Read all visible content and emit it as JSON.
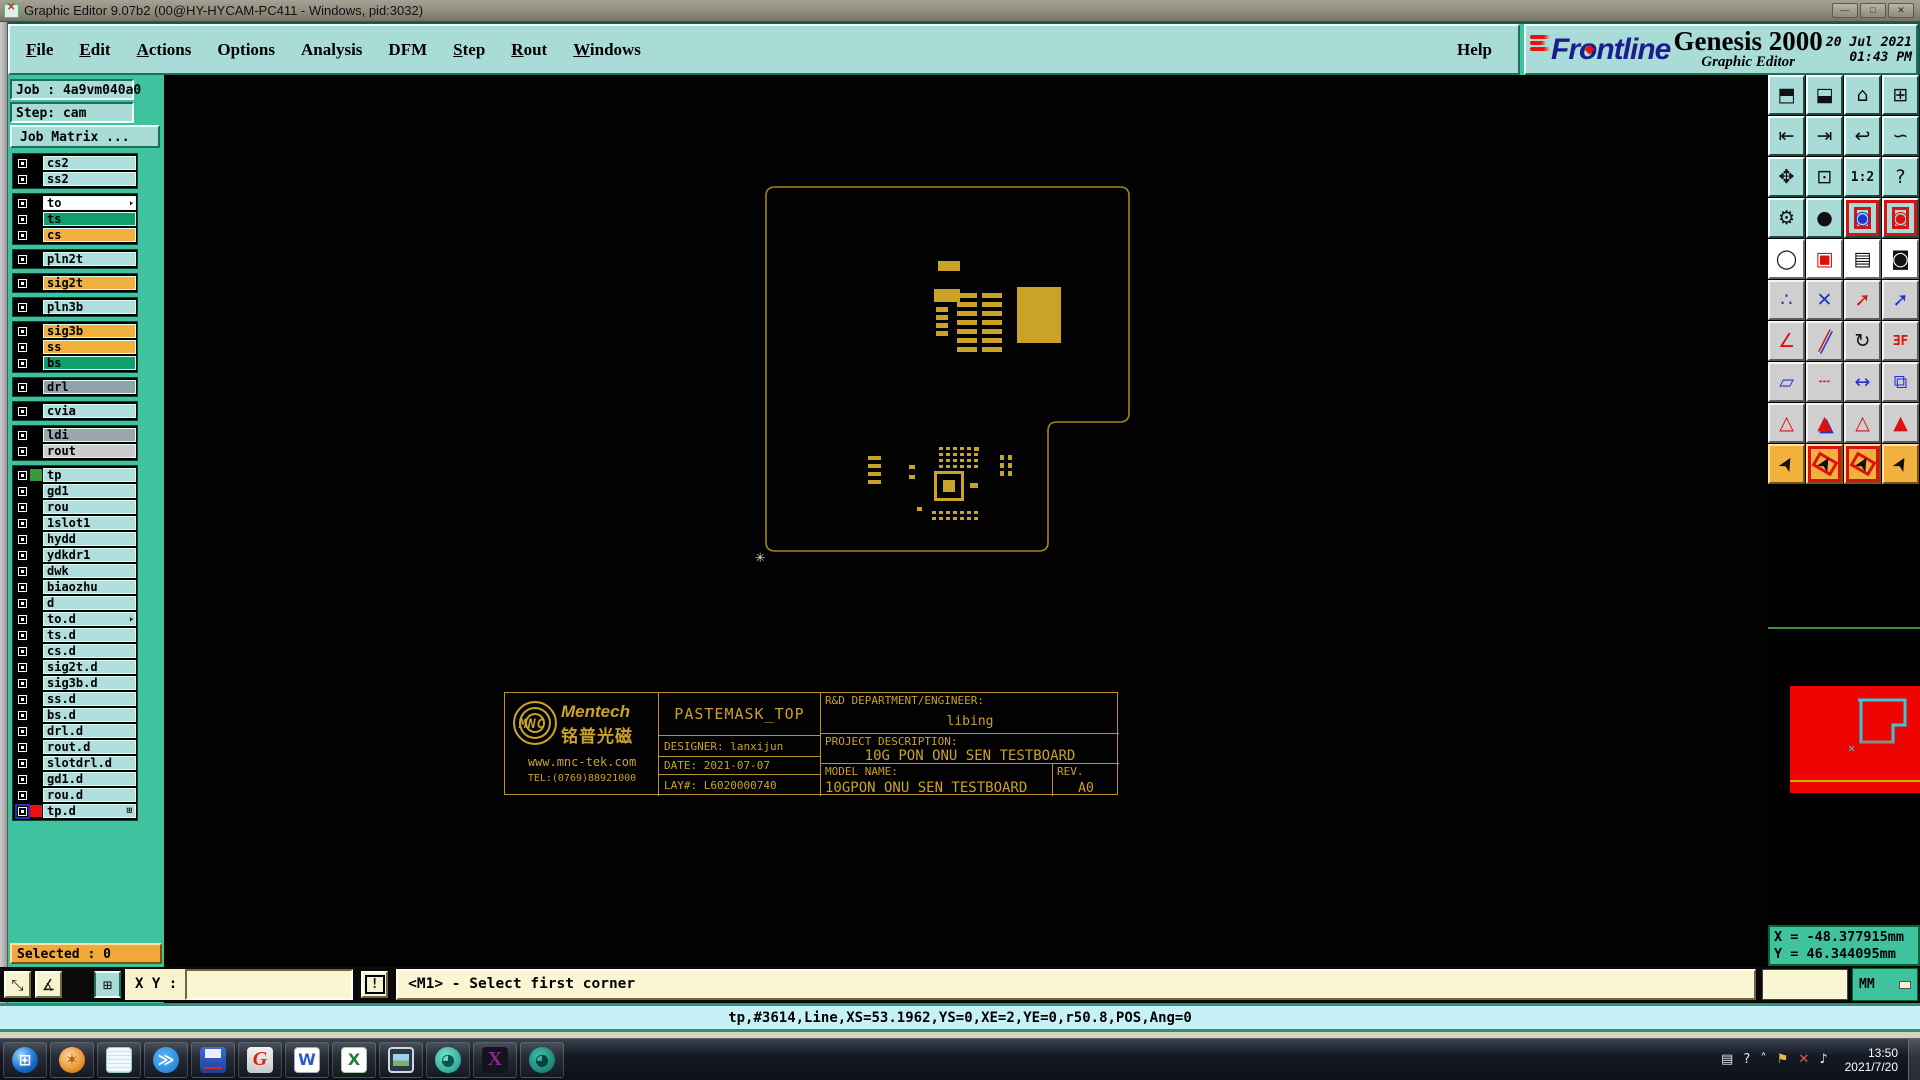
{
  "window": {
    "title": "Graphic Editor 9.07b2 (00@HY-HYCAM-PC411 - Windows, pid:3032)",
    "controls": [
      "—",
      "□",
      "✕"
    ]
  },
  "menu": {
    "items": [
      {
        "label": "File",
        "u": "F"
      },
      {
        "label": "Edit",
        "u": "E"
      },
      {
        "label": "Actions",
        "u": "A"
      },
      {
        "label": "Options",
        "u": ""
      },
      {
        "label": "Analysis",
        "u": ""
      },
      {
        "label": "DFM",
        "u": ""
      },
      {
        "label": "Step",
        "u": "S"
      },
      {
        "label": "Rout",
        "u": "R"
      },
      {
        "label": "Windows",
        "u": "W"
      }
    ],
    "help": "Help"
  },
  "brand": {
    "logo_text": "ntline",
    "logo_prefix": "Fr",
    "logo_o": "o",
    "product": "Genesis 2000",
    "subtitle": "Graphic Editor",
    "date": "20 Jul 2021",
    "time": "01:43 PM"
  },
  "sidebar": {
    "job": "Job : 4a9vm040a0",
    "step": "Step: cam",
    "job_matrix": "Job Matrix ...",
    "selected": "Selected : 0",
    "colors": {
      "teal": "#aedede",
      "orange": "#f2b13d",
      "green": "#0f9e6e",
      "white": "#ffffff",
      "slate": "#8fa3ad",
      "gray": "#9aa7ad",
      "lightgray": "#cccccc"
    },
    "groups": [
      [
        {
          "name": "cs2",
          "c": "teal"
        },
        {
          "name": "ss2",
          "c": "teal"
        }
      ],
      [
        {
          "name": "to",
          "c": "white",
          "arrow": true
        },
        {
          "name": "ts",
          "c": "green"
        },
        {
          "name": "cs",
          "c": "orange"
        }
      ],
      [
        {
          "name": "pln2t",
          "c": "teal"
        }
      ],
      [
        {
          "name": "sig2t",
          "c": "orange"
        }
      ],
      [
        {
          "name": "pln3b",
          "c": "teal"
        }
      ],
      [
        {
          "name": "sig3b",
          "c": "orange"
        },
        {
          "name": "ss",
          "c": "orange"
        },
        {
          "name": "bs",
          "c": "green"
        }
      ],
      [
        {
          "name": "drl",
          "c": "slate"
        }
      ],
      [
        {
          "name": "cvia",
          "c": "teal"
        }
      ],
      [
        {
          "name": "ldi",
          "c": "gray"
        },
        {
          "name": "rout",
          "c": "lightgray"
        }
      ],
      [
        {
          "name": "tp",
          "c": "teal",
          "swatch": "#3a9a3a"
        },
        {
          "name": "gd1",
          "c": "teal"
        },
        {
          "name": "rou",
          "c": "teal"
        },
        {
          "name": "1slot1",
          "c": "teal"
        },
        {
          "name": "hydd",
          "c": "teal"
        },
        {
          "name": "ydkdr1",
          "c": "teal"
        },
        {
          "name": "dwk",
          "c": "teal"
        },
        {
          "name": "biaozhu",
          "c": "teal"
        },
        {
          "name": "d",
          "c": "teal"
        },
        {
          "name": "to.d",
          "c": "teal",
          "arrow": true
        },
        {
          "name": "ts.d",
          "c": "teal"
        },
        {
          "name": "cs.d",
          "c": "teal"
        },
        {
          "name": "sig2t.d",
          "c": "teal"
        },
        {
          "name": "sig3b.d",
          "c": "teal"
        },
        {
          "name": "ss.d",
          "c": "teal"
        },
        {
          "name": "bs.d",
          "c": "teal"
        },
        {
          "name": "drl.d",
          "c": "teal"
        },
        {
          "name": "rout.d",
          "c": "teal"
        },
        {
          "name": "slotdrl.d",
          "c": "teal"
        },
        {
          "name": "gd1.d",
          "c": "teal"
        },
        {
          "name": "rou.d",
          "c": "teal"
        },
        {
          "name": "tp.d",
          "c": "teal",
          "swatch": "#ee1111",
          "selected": true,
          "grid": true
        }
      ]
    ]
  },
  "canvas": {
    "outline_color": "#9d8a14",
    "pad_color": "#c9a227",
    "board_path": "M 614 112 H 956 Q 965 112 965 121 V 338 Q 965 347 956 347 H 893 Q 884 347 884 356 V 467 Q 884 476 875 476 H 611 Q 602 476 602 467 V 121 Q 602 112 611 112 Z",
    "crosshair_glyph": "✳",
    "pads": [
      [
        774,
        186,
        22,
        10
      ],
      [
        770,
        214,
        26,
        13
      ],
      [
        853,
        212,
        44,
        56
      ],
      [
        745,
        390,
        6,
        4
      ],
      [
        745,
        400,
        6,
        4
      ],
      [
        806,
        408,
        8,
        5
      ],
      [
        753,
        432,
        5,
        4
      ],
      [
        810,
        372,
        5,
        4
      ]
    ],
    "pad_grids": [
      {
        "x": 793,
        "y": 218,
        "cols": 1,
        "rows": 7,
        "dx": 0,
        "dy": 9,
        "w": 20,
        "h": 5
      },
      {
        "x": 818,
        "y": 218,
        "cols": 1,
        "rows": 7,
        "dx": 0,
        "dy": 9,
        "w": 20,
        "h": 5
      },
      {
        "x": 772,
        "y": 232,
        "cols": 1,
        "rows": 4,
        "dx": 0,
        "dy": 8,
        "w": 12,
        "h": 5
      },
      {
        "x": 775,
        "y": 372,
        "cols": 6,
        "rows": 4,
        "dx": 7,
        "dy": 6,
        "w": 4,
        "h": 3
      },
      {
        "x": 768,
        "y": 436,
        "cols": 7,
        "rows": 2,
        "dx": 7,
        "dy": 6,
        "w": 4,
        "h": 3
      },
      {
        "x": 704,
        "y": 381,
        "cols": 1,
        "rows": 4,
        "dx": 0,
        "dy": 8,
        "w": 13,
        "h": 4
      },
      {
        "x": 836,
        "y": 380,
        "cols": 2,
        "rows": 3,
        "dx": 8,
        "dy": 8,
        "w": 4,
        "h": 5
      }
    ],
    "qfn_outline": [
      770,
      396,
      30,
      30
    ],
    "qfn_inner": [
      779,
      405,
      12,
      12
    ],
    "titleblock": {
      "mnc": "MNC",
      "mentech_en": "Mentech",
      "mentech_cn": "铭普光磁",
      "web": "www.mnc-tek.com",
      "tel": "TEL:(0769)88921000",
      "paste": "PASTEMASK_TOP",
      "designer": "DESIGNER: lanxijun",
      "date": "DATE: 2021-07-07",
      "lay": "LAY#: L6020000740",
      "rd_label": "R&D DEPARTMENT/ENGINEER:",
      "rd_value": "libing",
      "proj_label": "PROJECT DESCRIPTION:",
      "proj_value": "10G PON ONU SEN TESTBOARD",
      "model_label": "MODEL NAME:",
      "model_value": "10GPON ONU SEN TESTBOARD",
      "rev_label": "REV.",
      "rev_value": "A0"
    }
  },
  "right_toolbar": {
    "rows": [
      {
        "bg": "bg-teal",
        "btns": [
          {
            "n": "zoom-in",
            "g": "⬒"
          },
          {
            "n": "zoom-out",
            "g": "⬓"
          },
          {
            "n": "zoom-home",
            "g": "⌂"
          },
          {
            "n": "zoom-window-xy",
            "g": "⊞"
          }
        ]
      },
      {
        "bg": "bg-teal",
        "btns": [
          {
            "n": "pan-left",
            "g": "⇤"
          },
          {
            "n": "pan-right",
            "g": "⇥"
          },
          {
            "n": "previous-view",
            "g": "↩"
          },
          {
            "n": "redraw",
            "g": "∽"
          }
        ]
      },
      {
        "bg": "bg-teal",
        "btns": [
          {
            "n": "zoom-expand",
            "g": "✥"
          },
          {
            "n": "zoom-center",
            "g": "⊡"
          },
          {
            "n": "scale-1-2",
            "g": "1:2",
            "cls": "txt-sm"
          },
          {
            "n": "context-help",
            "g": "?"
          }
        ]
      },
      {
        "bg": "bg-teal",
        "btns": [
          {
            "n": "setup-tools",
            "g": "⚙"
          },
          {
            "n": "highlight-pad",
            "g": "●"
          },
          {
            "n": "net-reference-a",
            "g": "◉",
            "cls": "deco-redbox fg-blue"
          },
          {
            "n": "net-reference-b",
            "g": "◉",
            "cls": "deco-redbox fg-red"
          }
        ]
      },
      {
        "bg": "bg-white",
        "btns": [
          {
            "n": "copy-to-layer",
            "g": "◯"
          },
          {
            "n": "reference-frame",
            "g": "▣",
            "cls": "fg-red"
          },
          {
            "n": "measure-ruler",
            "g": "▤"
          },
          {
            "n": "select-reference",
            "g": "◙"
          }
        ]
      },
      {
        "bg": "bg-gray",
        "btns": [
          {
            "n": "net-points",
            "g": "∴",
            "cls": "fg-blue"
          },
          {
            "n": "delete-item",
            "g": "✕",
            "cls": "fg-blue"
          },
          {
            "n": "move-origin",
            "g": "➚",
            "cls": "fg-red"
          },
          {
            "n": "copy-vector",
            "g": "➚",
            "cls": "fg-blue"
          }
        ]
      },
      {
        "bg": "bg-gray",
        "btns": [
          {
            "n": "rotate-angle",
            "g": "∠",
            "cls": "fg-red"
          },
          {
            "n": "mirror-line",
            "g": "╱",
            "cls": "fg-redblue"
          },
          {
            "n": "rotate-90",
            "g": "↻"
          },
          {
            "n": "mirror-text",
            "g": "ƎF",
            "cls": "txt-sm fg-red"
          }
        ]
      },
      {
        "bg": "bg-gray",
        "btns": [
          {
            "n": "swap-pads",
            "g": "▱",
            "cls": "fg-blue"
          },
          {
            "n": "break-line",
            "g": "┄",
            "cls": "fg-red"
          },
          {
            "n": "dimension",
            "g": "↔",
            "cls": "fg-blue"
          },
          {
            "n": "merge-shapes",
            "g": "⧉",
            "cls": "fg-blue"
          }
        ]
      },
      {
        "bg": "bg-gray",
        "btns": [
          {
            "n": "arrow-tool-a",
            "g": "△",
            "cls": "fg-red"
          },
          {
            "n": "arrow-tool-b",
            "g": "▲",
            "cls": "fg-redblue"
          },
          {
            "n": "arrow-tool-c",
            "g": "△",
            "cls": "fg-red"
          },
          {
            "n": "arrow-tool-d",
            "g": "▲",
            "cls": "fg-red"
          }
        ]
      },
      {
        "bg": "bg-orange",
        "btns": [
          {
            "n": "select-mode",
            "g": "➤",
            "cls": "rot"
          },
          {
            "n": "select-frame",
            "g": "➤",
            "cls": "rot deco-redbox"
          },
          {
            "n": "select-polygon",
            "g": "➤",
            "cls": "rot deco-redbox"
          },
          {
            "n": "select-net",
            "g": "➤",
            "cls": "rot"
          }
        ]
      }
    ]
  },
  "bottom": {
    "xy_label": "X Y :",
    "xy_value": "",
    "excl": "!",
    "prompt": "<M1> - Select first corner",
    "status": "tp,#3614,Line,XS=53.1962,YS=0,XE=2,YE=0,r50.8,POS,Ang=0",
    "units": "MM",
    "coord_x": "X = -48.377915mm",
    "coord_y": "Y = 46.344095mm",
    "tool_icons": [
      {
        "n": "zoom-area-icon",
        "g": "⤡"
      },
      {
        "n": "measure-angle-icon",
        "g": "∡"
      },
      {
        "n": "grid-toggle-icon",
        "g": "⊞"
      }
    ]
  },
  "taskbar": {
    "icons": [
      {
        "n": "start-button",
        "cls": "ic-start",
        "g": "⊞"
      },
      {
        "n": "shell-app-icon",
        "cls": "ic-shell",
        "g": "✶"
      },
      {
        "n": "notepad-icon",
        "cls": "ic-notepad",
        "g": ""
      },
      {
        "n": "dingtalk-icon",
        "cls": "ic-ding",
        "g": "≫"
      },
      {
        "n": "save-tool-icon",
        "cls": "ic-floppy",
        "g": ""
      },
      {
        "n": "genesis-g-icon",
        "cls": "ic-g",
        "g": "G"
      },
      {
        "n": "wps-word-icon",
        "cls": "ic-word",
        "g": "W"
      },
      {
        "n": "wps-excel-icon",
        "cls": "ic-excel",
        "g": "X"
      },
      {
        "n": "photo-viewer-icon",
        "cls": "ic-photo",
        "g": ""
      },
      {
        "n": "capture-app-icon",
        "cls": "ic-cam",
        "g": "◕"
      },
      {
        "n": "exceed-x-icon",
        "cls": "ic-x",
        "g": "X"
      },
      {
        "n": "recorder-app-icon",
        "cls": "ic-snag",
        "g": "◕"
      }
    ],
    "tray": [
      {
        "n": "printer-tray-icon",
        "g": "▤"
      },
      {
        "n": "help-tray-icon",
        "g": "?"
      },
      {
        "n": "expand-tray-icon",
        "g": "˄"
      },
      {
        "n": "flag-tray-icon",
        "g": "⚑"
      },
      {
        "n": "alert-tray-icon",
        "g": "✕"
      },
      {
        "n": "volume-tray-icon",
        "g": "♪"
      }
    ],
    "clock_time": "13:50",
    "clock_date": "2021/7/20"
  }
}
